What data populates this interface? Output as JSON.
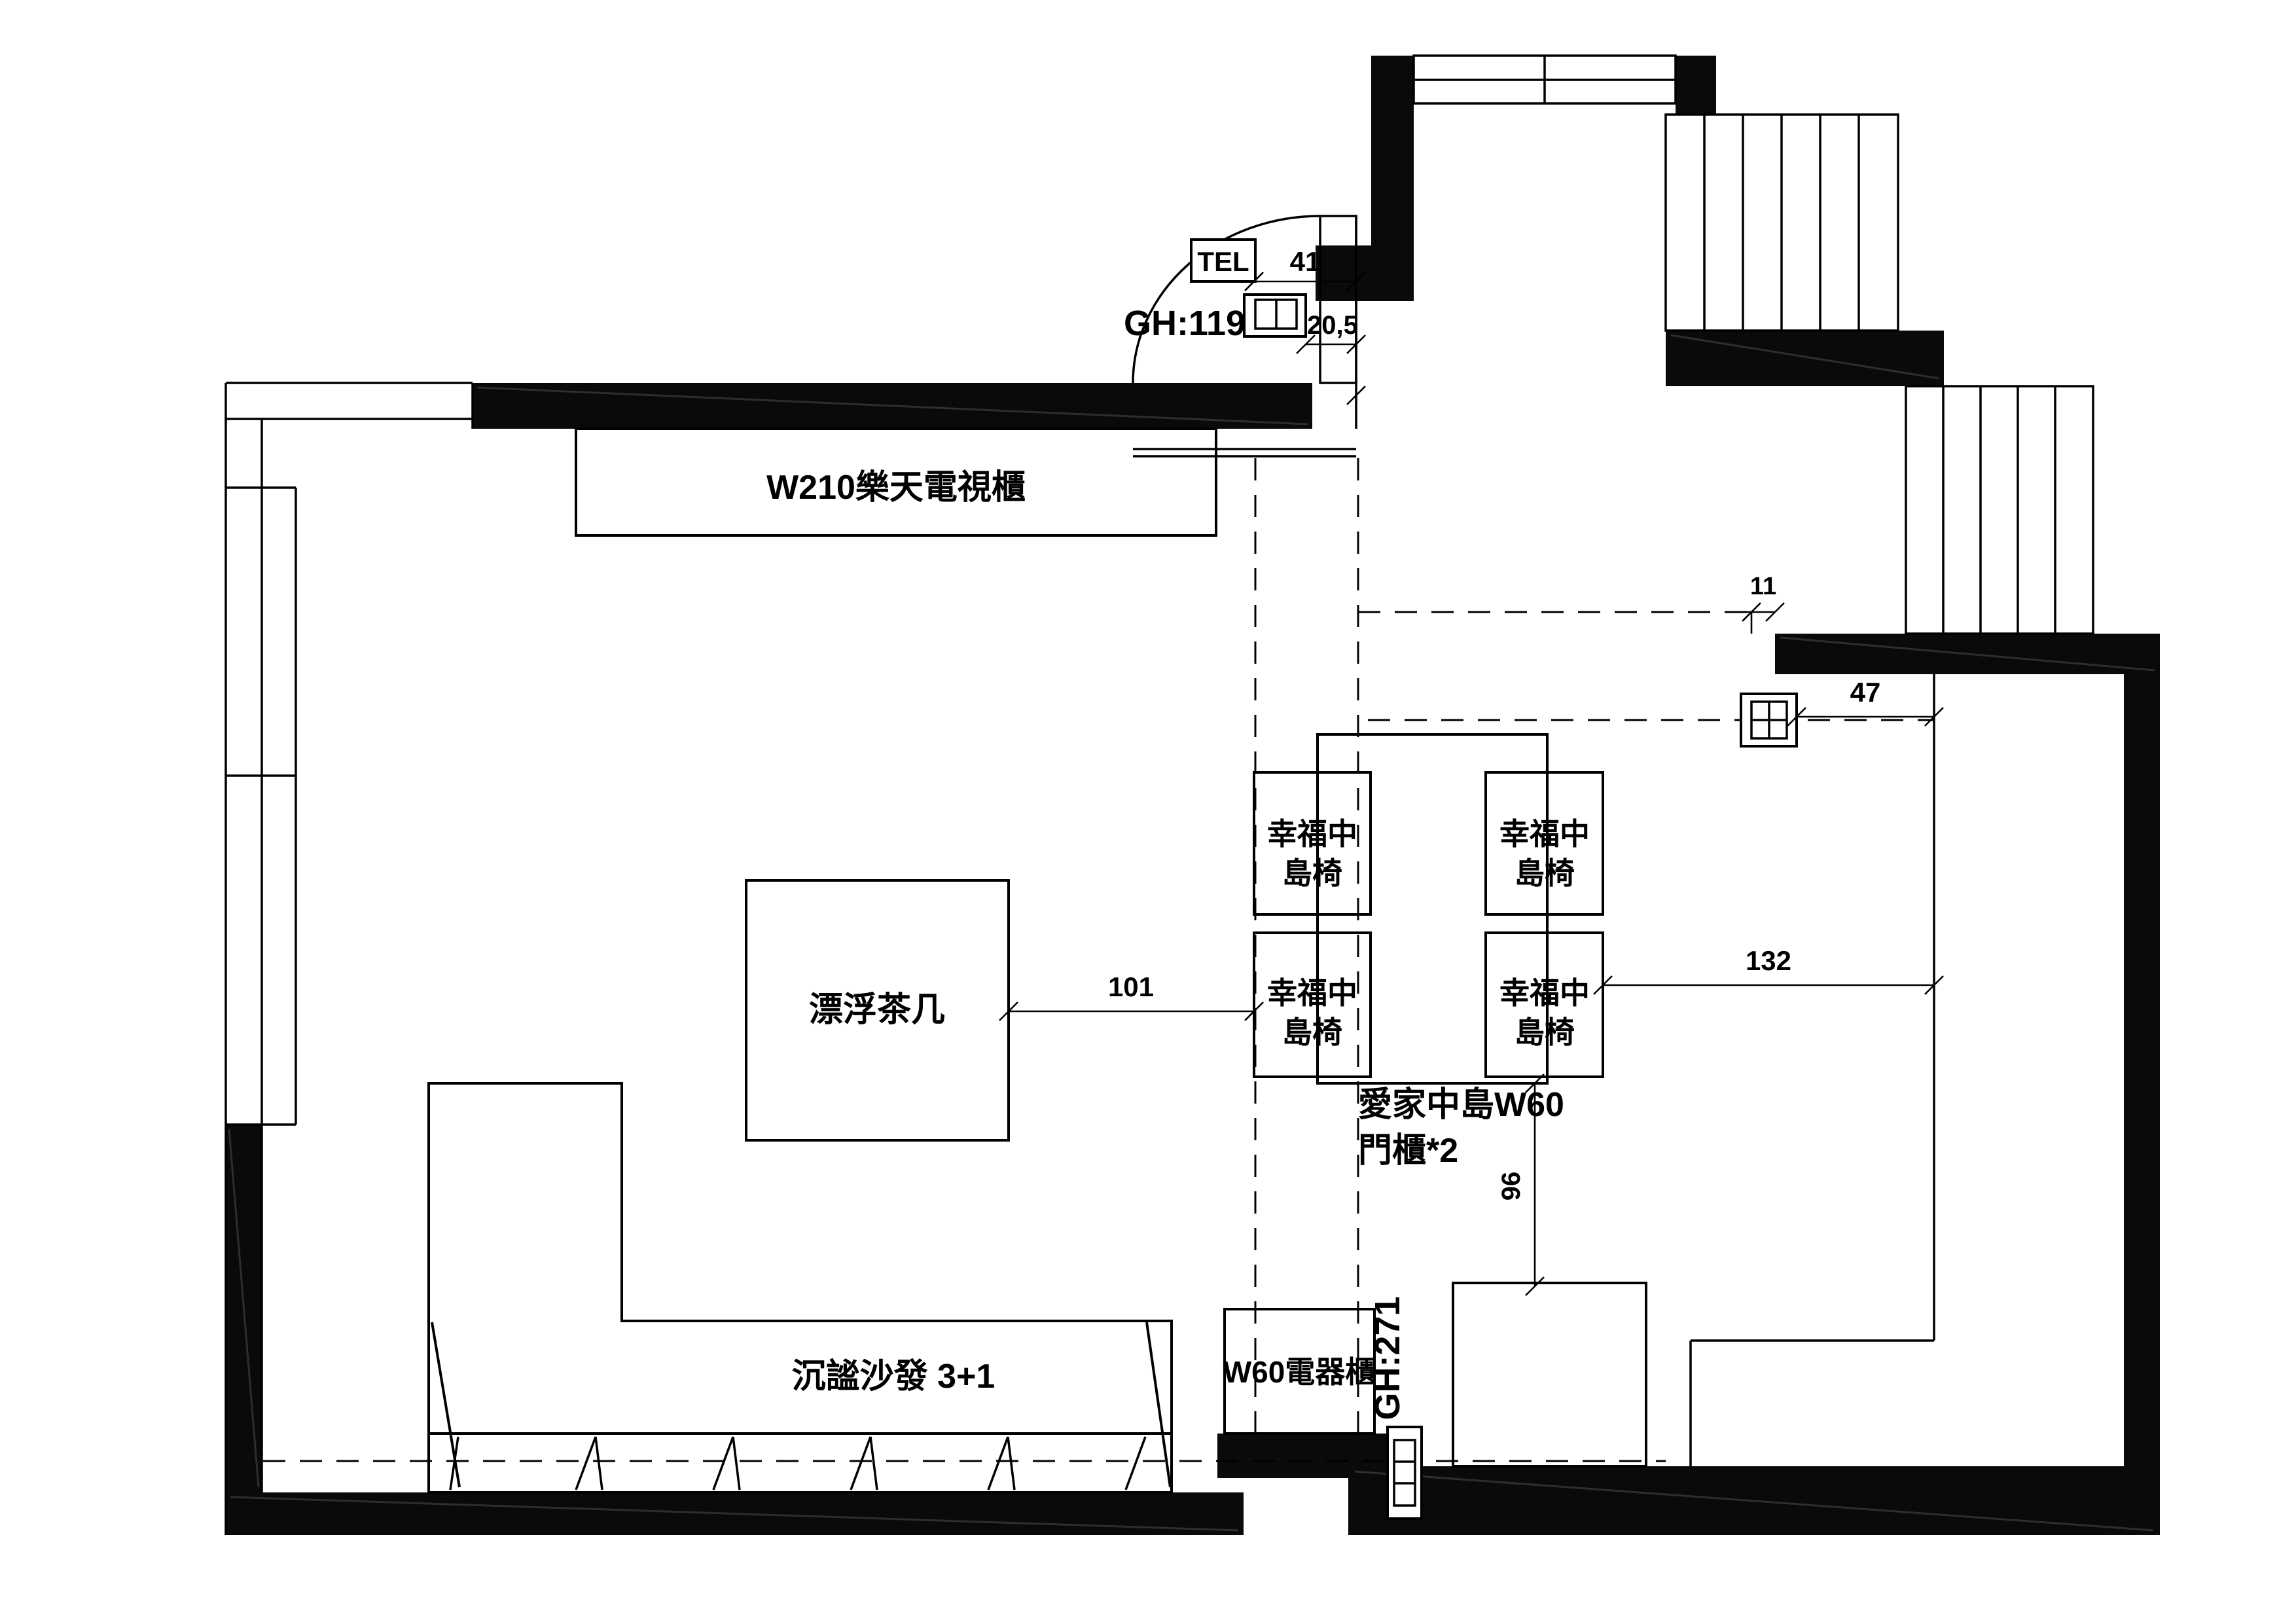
{
  "title": "living-room-floor-plan",
  "labels": {
    "tv_cabinet": "W210樂天電視櫃",
    "coffee_table": "漂浮茶几",
    "sofa": "沉謐沙發 3+1",
    "chair_line1": "幸福中",
    "chair_line2": "島椅",
    "island_line1": "愛家中島W60",
    "island_line2": "門櫃*2",
    "appliance_cabinet": "W60電器櫃",
    "tel": "TEL",
    "door_height_entry": "GH:119",
    "door_height_back": "GH:271"
  },
  "dimensions": {
    "entry_width": "41",
    "entry_depth": "20,5",
    "wall_offset": "11",
    "counter_gap": "47",
    "table_to_island": "101",
    "island_to_wall": "132",
    "island_to_cabinet": "96"
  },
  "colors": {
    "line": "#000000",
    "wall_fill": "#0a0a0a",
    "background": "#ffffff"
  }
}
